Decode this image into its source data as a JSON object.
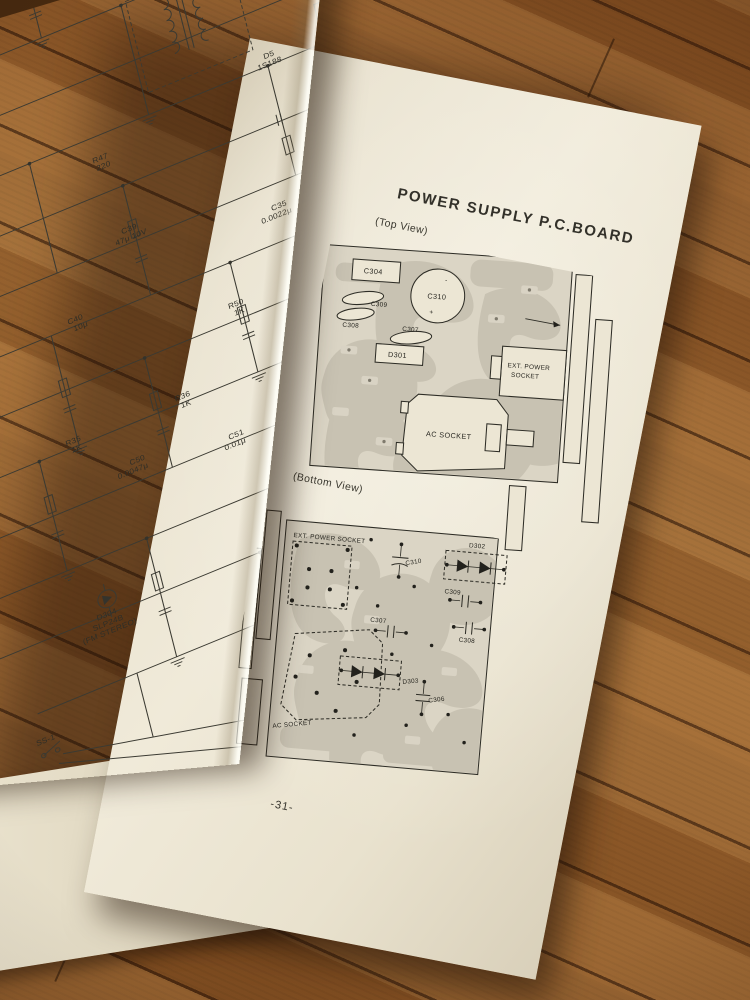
{
  "book": {
    "right_page": {
      "title": "POWER SUPPLY P.C.BOARD",
      "page_number": "-31-",
      "top_view": {
        "caption": "(Top View)",
        "components": {
          "c304": "C304",
          "c309": "C309",
          "c308": "C308",
          "c310": "C310",
          "c310_minus": "-",
          "c310_plus": "+",
          "c307": "C307",
          "d301": "D301",
          "ext_power_l1": "EXT. POWER",
          "ext_power_l2": "SOCKET",
          "ac_socket": "AC  SOCKET"
        }
      },
      "bottom_view": {
        "caption": "(Bottom View)",
        "components": {
          "ext_power_socket": "EXT.  POWER  SOCKET",
          "c310": "C310",
          "d302": "D302",
          "c309": "C309",
          "c308": "C308",
          "c307": "C307",
          "d303": "D303",
          "c306": "C306",
          "ac_socket": "AC  SOCKET"
        }
      }
    },
    "left_page": {
      "schematic_labels": [
        {
          "t": "C25",
          "x": 60,
          "y": 30
        },
        {
          "t": "0.022μ",
          "x": 52,
          "y": 39
        },
        {
          "t": "R15",
          "x": 128,
          "y": 54
        },
        {
          "t": "1K",
          "x": 132,
          "y": 63
        },
        {
          "t": "C47",
          "x": 208,
          "y": 28
        },
        {
          "t": "0.022μ",
          "x": 200,
          "y": 37
        },
        {
          "t": "T7",
          "x": 350,
          "y": 114
        },
        {
          "t": "C37",
          "x": 428,
          "y": 130
        },
        {
          "t": "10μ",
          "x": 430,
          "y": 139
        },
        {
          "t": "R29",
          "x": 452,
          "y": 170
        },
        {
          "t": "10K",
          "x": 452,
          "y": 179
        },
        {
          "t": "D5",
          "x": 418,
          "y": 234
        },
        {
          "t": "1S188",
          "x": 410,
          "y": 243
        },
        {
          "t": "R47",
          "x": 238,
          "y": 268
        },
        {
          "t": "220",
          "x": 240,
          "y": 277
        },
        {
          "t": "AM 0V",
          "x": 26,
          "y": 330
        },
        {
          "t": "FM 6.05V",
          "x": 20,
          "y": 339
        },
        {
          "t": "C39",
          "x": 248,
          "y": 350
        },
        {
          "t": "47μ 10V",
          "x": 240,
          "y": 359
        },
        {
          "t": "R32",
          "x": 468,
          "y": 330
        },
        {
          "t": "22K",
          "x": 468,
          "y": 339
        },
        {
          "t": "C35",
          "x": 390,
          "y": 388
        },
        {
          "t": "0.0022μ",
          "x": 378,
          "y": 397
        },
        {
          "t": "C40",
          "x": 178,
          "y": 418
        },
        {
          "t": "10μ",
          "x": 182,
          "y": 427
        },
        {
          "t": "AM CV",
          "x": 22,
          "y": 450
        },
        {
          "t": "FM 2.1V",
          "x": 18,
          "y": 459
        },
        {
          "t": "C36",
          "x": 466,
          "y": 428
        },
        {
          "t": "0.0022μ",
          "x": 454,
          "y": 437
        },
        {
          "t": "R50",
          "x": 328,
          "y": 468
        },
        {
          "t": "1K",
          "x": 332,
          "y": 477
        },
        {
          "t": "C24",
          "x": 498,
          "y": 488
        },
        {
          "t": "10μ",
          "x": 500,
          "y": 497
        },
        {
          "t": "R35",
          "x": 148,
          "y": 538
        },
        {
          "t": "1K",
          "x": 152,
          "y": 547
        },
        {
          "t": "R36",
          "x": 258,
          "y": 538
        },
        {
          "t": "1K",
          "x": 262,
          "y": 547
        },
        {
          "t": "C64",
          "x": 378,
          "y": 558
        },
        {
          "t": "0.01μ",
          "x": 372,
          "y": 567
        },
        {
          "t": "C50",
          "x": 202,
          "y": 583
        },
        {
          "t": "0.0047μ",
          "x": 188,
          "y": 592
        },
        {
          "t": "C51",
          "x": 298,
          "y": 598
        },
        {
          "t": "0.01μ",
          "x": 292,
          "y": 607
        },
        {
          "t": "R48 12K",
          "x": 352,
          "y": 638
        },
        {
          "t": "D304",
          "x": 136,
          "y": 724
        },
        {
          "t": "SLP24B",
          "x": 130,
          "y": 733
        },
        {
          "t": "(FM STEREO)",
          "x": 118,
          "y": 742
        },
        {
          "t": "SS-1",
          "x": 52,
          "y": 824
        }
      ]
    }
  },
  "colors": {
    "paper": "#f0ead9",
    "panel": "#dbd5c5",
    "trace_gray": "#c8c2b2",
    "ink": "#2e2d26",
    "wood": "#96602c"
  }
}
